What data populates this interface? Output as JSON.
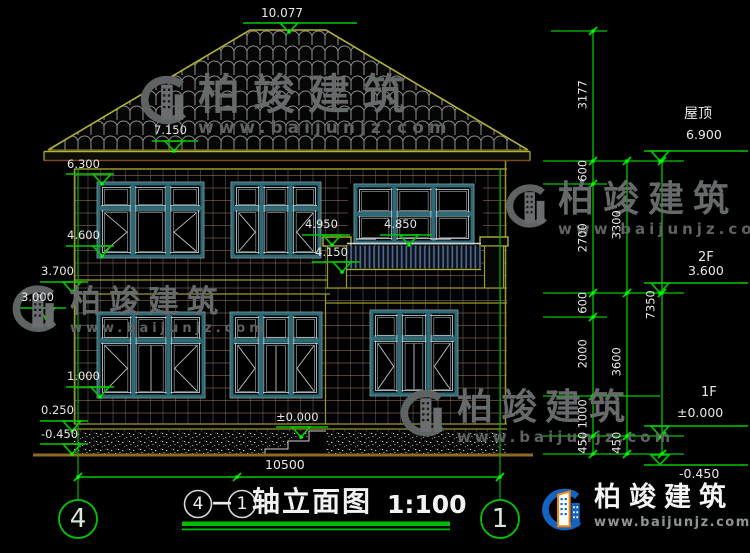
{
  "title": {
    "separator": "—",
    "text": "轴立面图",
    "scale": "1:100"
  },
  "axes": {
    "left": "4",
    "right": "1"
  },
  "brand": {
    "name": "柏竣建筑",
    "url": "www.baijunjz.com"
  },
  "elevation_labels": {
    "peak": "10.077",
    "roof_eave": "7.150",
    "wall_top": "6.300",
    "rail_top": "4.950",
    "balcony_door_sill": "4.850",
    "win2f_sill": "4.600",
    "balcony_floor": "4.150",
    "slab_top": "3.700",
    "slab_bottom": "3.000",
    "win1f_sill": "1.000",
    "plinth": "0.250",
    "ground": "-0.450",
    "zero": "±0.000"
  },
  "story_levels": {
    "roof_label": "屋顶",
    "roof_value": "6.900",
    "f2_label": "2F",
    "f2_value": "3.600",
    "f1_label": "1F",
    "f1_value": "±0.000",
    "ground_value": "-0.450"
  },
  "dimensions": {
    "total_width": "10500",
    "total_height": "7350",
    "roof_rise": "3177",
    "d600": "600",
    "d2700": "2700",
    "d2000": "2000",
    "d1000": "1000",
    "d450": "450",
    "d3300": "3300",
    "d3600": "3600"
  },
  "colors": {
    "background": "#000000",
    "dimension_green": "#00c800",
    "grip_green": "#00ff00",
    "outline_olive": "#b2b236",
    "window_teal": "#2b6a77",
    "text_white": "#e9e9e9",
    "ground_brown": "#8f6b1f",
    "logo_blue": "#1464c2",
    "logo_orange": "#ef8412",
    "watermark_gray": "#666a6a"
  }
}
